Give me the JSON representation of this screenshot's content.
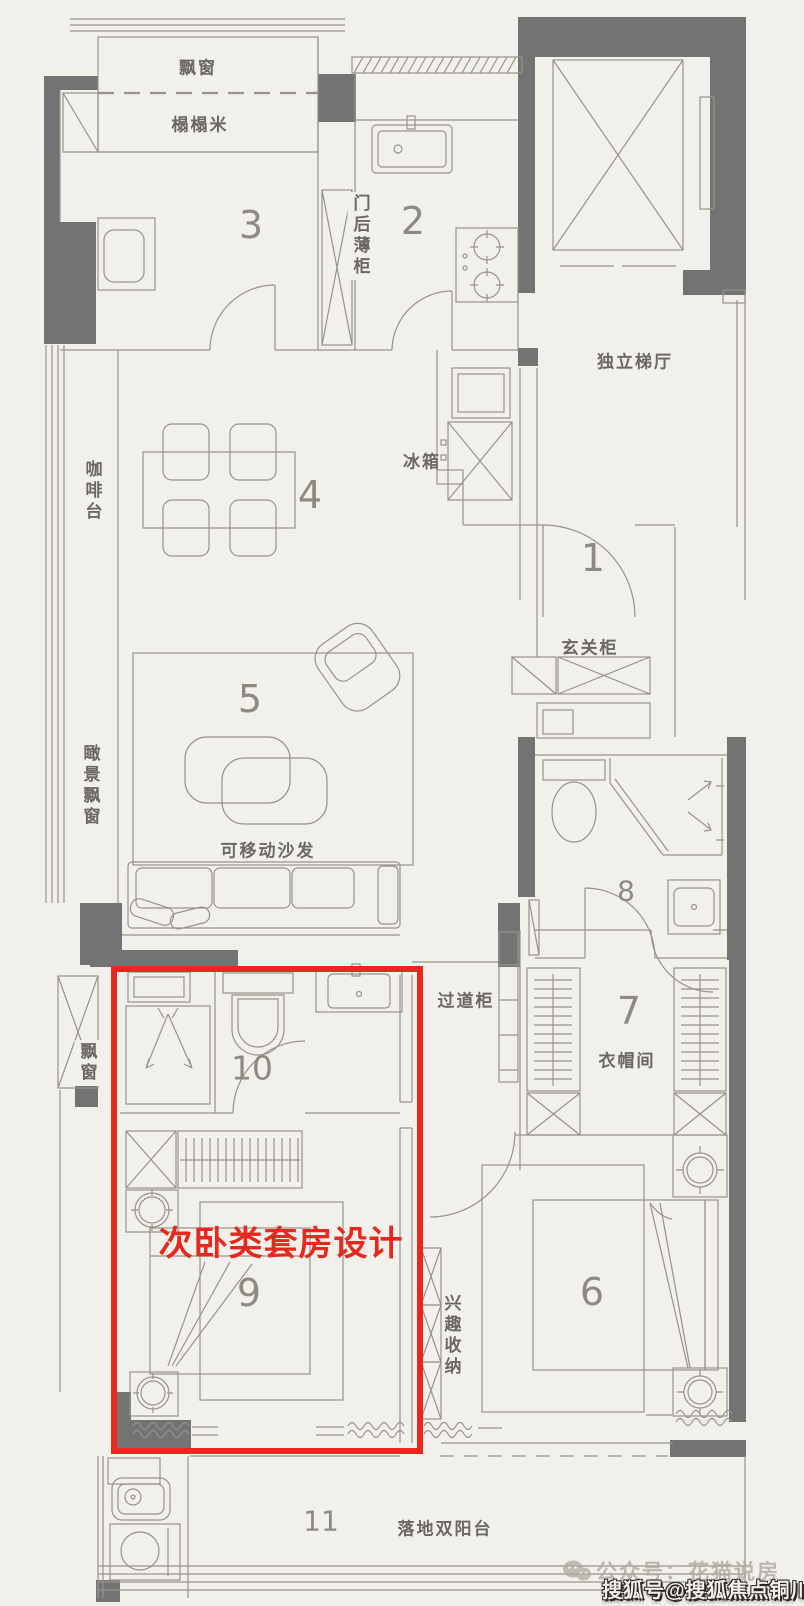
{
  "page": {
    "width": 804,
    "height": 1606,
    "background": "#f2f0eb"
  },
  "colors": {
    "wall": "#737373",
    "line": "#97938b",
    "label_text": "#6b6862",
    "room_number": "#8d8a82",
    "highlight_red": "#e8281e",
    "watermark_gray": "#aeaaa1",
    "watermark_sohu_text": "#f3efe7"
  },
  "rooms": [
    {
      "id": "entry-hall",
      "number": "1"
    },
    {
      "id": "kitchen",
      "number": "2"
    },
    {
      "id": "tatami-room",
      "number": "3"
    },
    {
      "id": "dining-area",
      "number": "4"
    },
    {
      "id": "living-area",
      "number": "5"
    },
    {
      "id": "master-bedroom",
      "number": "6"
    },
    {
      "id": "cloakroom",
      "number": "7"
    },
    {
      "id": "main-bathroom",
      "number": "8"
    },
    {
      "id": "secondary-bedroom",
      "number": "9"
    },
    {
      "id": "ensuite-bathroom",
      "number": "10"
    },
    {
      "id": "balcony",
      "number": "11"
    }
  ],
  "labels": {
    "bay_window_top": "飘窗",
    "tatami": "榻榻米",
    "behind_door_cabinet": "门后薄柜",
    "elevator_hall": "独立梯厅",
    "fridge": "冰箱",
    "coffee_counter": "咖啡台",
    "entry_cabinet": "玄关柜",
    "view_bay_window": "瞰景飘窗",
    "movable_sofa": "可移动沙发",
    "hallway_cabinet": "过道柜",
    "cloakroom": "衣帽间",
    "bay_window_left": "飘窗",
    "hobby_storage": "兴趣收纳",
    "balcony": "落地双阳台"
  },
  "annotation": {
    "highlight_title": "次卧类套房设计",
    "highlight_color": "#e8281e"
  },
  "watermarks": {
    "wechat": {
      "icon": "wechat-icon",
      "text": "公众号：花猫说房"
    },
    "sohu": {
      "text": "搜狐号@搜狐焦点铜川站"
    }
  }
}
